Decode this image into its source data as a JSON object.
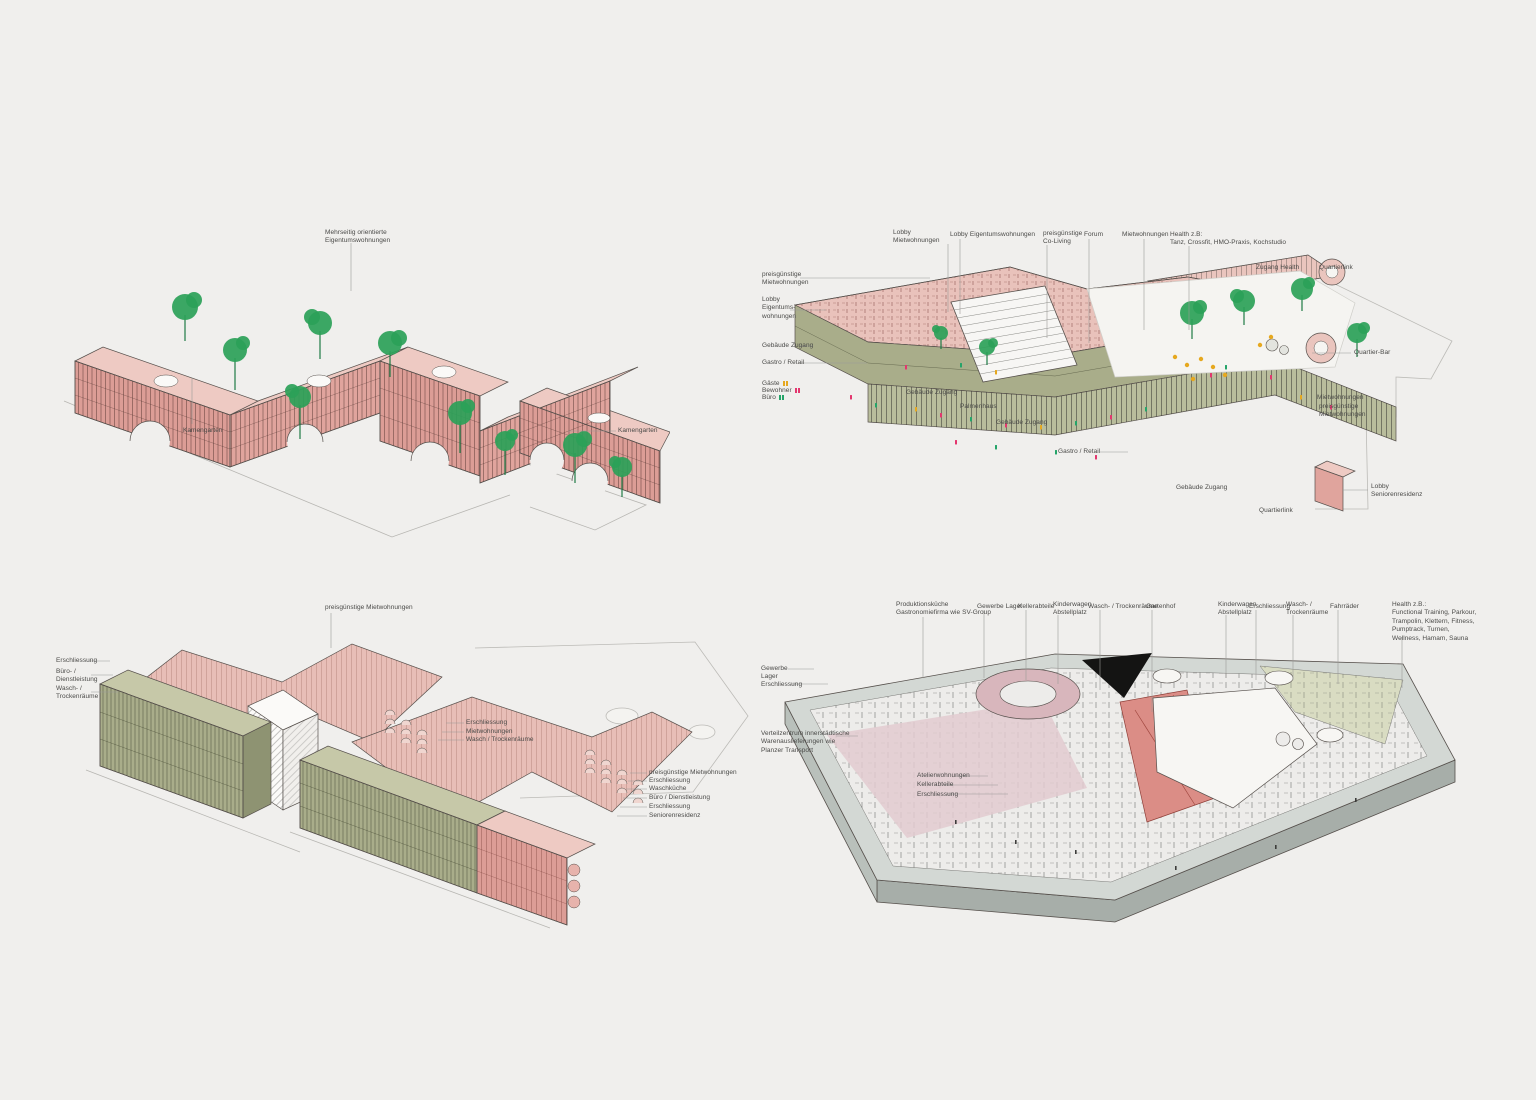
{
  "page": {
    "background": "#f0efed",
    "ink": "#56504c",
    "label_color": "#4a4a48"
  },
  "figure": {
    "type": "architectural-axonometric-set",
    "panel_count": 4
  },
  "palette": {
    "pink_wall": "#dc9d96",
    "pink_roof": "#eecac3",
    "olive": "#a9ad8a",
    "tree_green": "#2ba158",
    "grey_plate": "#d3d8d4",
    "people_guest": "#e6a81f",
    "people_resident": "#e3366e",
    "people_office": "#25a469"
  },
  "panels": [
    {
      "id": "upper-floors",
      "name": "axon-upper-floors",
      "annotations": [
        {
          "t": [
            "Mehrseitig orientierte",
            "Eigentumswohnungen"
          ],
          "x": 325,
          "y": 229,
          "l": [
            351,
            243,
            351,
            291
          ]
        },
        {
          "t": [
            "Kamengarten"
          ],
          "x": 183,
          "y": 427,
          "l": [
            192,
            424,
            192,
            378
          ]
        },
        {
          "t": [
            "Kamengarten"
          ],
          "x": 618,
          "y": 427,
          "l": [
            616,
            431,
            568,
            431
          ]
        }
      ]
    },
    {
      "id": "ground-floor",
      "name": "axon-ground-floor",
      "annotations": [
        {
          "t": [
            "Lobby",
            "Mietwohnungen"
          ],
          "x": 893,
          "y": 229,
          "l": [
            948,
            244,
            948,
            312
          ]
        },
        {
          "t": [
            "Lobby Eigentumswohnungen"
          ],
          "x": 950,
          "y": 231,
          "l": [
            960,
            239,
            960,
            314
          ]
        },
        {
          "t": [
            "preisgünstige",
            "Co-Living"
          ],
          "x": 1043,
          "y": 230,
          "l": [
            1047,
            245,
            1047,
            338
          ]
        },
        {
          "t": [
            "Forum"
          ],
          "x": 1084,
          "y": 231,
          "l": [
            1089,
            239,
            1089,
            343
          ]
        },
        {
          "t": [
            "Mietwohnungen"
          ],
          "x": 1122,
          "y": 231,
          "l": [
            1144,
            239,
            1144,
            330
          ]
        },
        {
          "t": [
            "Health z.B:",
            "Tanz, Crossfit, HMO-Praxis, Kochstudio"
          ],
          "x": 1170,
          "y": 231,
          "l": [
            1189,
            246,
            1189,
            330
          ]
        },
        {
          "t": [
            "Zugang Health"
          ],
          "x": 1256,
          "y": 264
        },
        {
          "t": [
            "Quartierlink"
          ],
          "x": 1319,
          "y": 264
        },
        {
          "t": [
            "Quartier-Bar"
          ],
          "x": 1354,
          "y": 349,
          "l": [
            1351,
            353,
            1312,
            353
          ]
        },
        {
          "t": [
            "preisgünstige",
            "Mietwohnungen"
          ],
          "x": 762,
          "y": 271,
          "l": [
            800,
            278,
            930,
            278
          ]
        },
        {
          "t": [
            "Lobby",
            "Eigentums-",
            "wohnungen"
          ],
          "x": 762,
          "y": 296,
          "l": [
            790,
            310,
            826,
            310
          ]
        },
        {
          "t": [
            "Gebäude Zugang"
          ],
          "x": 762,
          "y": 342,
          "l": [
            800,
            346,
            813,
            346
          ]
        },
        {
          "t": [
            "Gastro / Retail"
          ],
          "x": 762,
          "y": 359,
          "l": [
            801,
            363,
            867,
            363
          ]
        },
        {
          "t": [
            "Gäste"
          ],
          "x": 762,
          "y": 380,
          "m": "#e6a81f"
        },
        {
          "t": [
            "Bewohner"
          ],
          "x": 762,
          "y": 387,
          "m": "#e3366e"
        },
        {
          "t": [
            "Büro"
          ],
          "x": 762,
          "y": 394,
          "m": "#25a469"
        },
        {
          "t": [
            "Gebäude Zugang"
          ],
          "x": 906,
          "y": 389
        },
        {
          "t": [
            "Palmenhaus"
          ],
          "x": 960,
          "y": 403
        },
        {
          "t": [
            "Gebäude Zugang"
          ],
          "x": 996,
          "y": 419
        },
        {
          "t": [
            "Gastro / Retail"
          ],
          "x": 1058,
          "y": 448,
          "l": [
            1100,
            452,
            1128,
            452
          ]
        },
        {
          "t": [
            "Gebäude Zugang"
          ],
          "x": 1176,
          "y": 484
        },
        {
          "t": [
            "Quartierlink"
          ],
          "x": 1259,
          "y": 507
        },
        {
          "t": [
            "Lobby",
            "Seniorenresidenz"
          ],
          "x": 1371,
          "y": 483,
          "l": [
            1368,
            490,
            1342,
            490
          ]
        },
        {
          "t": [
            "Mietwohnungen"
          ],
          "x": 1317,
          "y": 394
        },
        {
          "t": [
            "preisgünstige",
            "Mietwohnungen"
          ],
          "x": 1319,
          "y": 403
        }
      ]
    },
    {
      "id": "standard-floors",
      "name": "axon-standard-floors",
      "annotations": [
        {
          "t": [
            "preisgünstige Mietwohnungen"
          ],
          "x": 325,
          "y": 604,
          "l": [
            331,
            613,
            331,
            648
          ]
        },
        {
          "t": [
            "Erschliessung"
          ],
          "x": 56,
          "y": 657,
          "l": [
            89,
            661,
            110,
            661
          ]
        },
        {
          "t": [
            "Büro- /",
            "Dienstleistung"
          ],
          "x": 56,
          "y": 668,
          "l": [
            91,
            675,
            113,
            675
          ]
        },
        {
          "t": [
            "Wasch- /",
            "Trockenräume"
          ],
          "x": 56,
          "y": 685,
          "l": [
            91,
            692,
            118,
            692
          ]
        },
        {
          "t": [
            "Erschliessung"
          ],
          "x": 466,
          "y": 719,
          "l": [
            464,
            723,
            446,
            723
          ]
        },
        {
          "t": [
            "Mietwohnungen"
          ],
          "x": 466,
          "y": 728,
          "l": [
            464,
            732,
            442,
            732
          ]
        },
        {
          "t": [
            "Wasch / Trockenräume"
          ],
          "x": 466,
          "y": 736,
          "l": [
            464,
            740,
            438,
            740
          ]
        },
        {
          "t": [
            "preisgünstige Mietwohnungen"
          ],
          "x": 649,
          "y": 769,
          "l": [
            647,
            773,
            630,
            773
          ]
        },
        {
          "t": [
            "Erschliessung"
          ],
          "x": 649,
          "y": 777,
          "l": [
            647,
            781,
            628,
            781
          ]
        },
        {
          "t": [
            "Waschküche"
          ],
          "x": 649,
          "y": 785,
          "l": [
            647,
            789,
            626,
            789
          ]
        },
        {
          "t": [
            "Büro / Dienstleistung"
          ],
          "x": 649,
          "y": 794,
          "l": [
            647,
            798,
            623,
            798
          ]
        },
        {
          "t": [
            "Erschliessung"
          ],
          "x": 649,
          "y": 803,
          "l": [
            647,
            807,
            620,
            807
          ]
        },
        {
          "t": [
            "Seniorenresidenz"
          ],
          "x": 649,
          "y": 812,
          "l": [
            647,
            816,
            617,
            816
          ]
        }
      ]
    },
    {
      "id": "basement",
      "name": "axon-basement",
      "annotations": [
        {
          "t": [
            "Produktionsküche",
            "Gastronomiefirma wie SV-Group"
          ],
          "x": 896,
          "y": 601,
          "l": [
            923,
            617,
            923,
            678
          ]
        },
        {
          "t": [
            "Gewerbe Lager"
          ],
          "x": 977,
          "y": 603,
          "l": [
            984,
            610,
            984,
            678
          ]
        },
        {
          "t": [
            "Kellerabteile"
          ],
          "x": 1018,
          "y": 603,
          "l": [
            1026,
            610,
            1026,
            680
          ]
        },
        {
          "t": [
            "Kinderwagen",
            "Abstellplatz"
          ],
          "x": 1053,
          "y": 601,
          "l": [
            1058,
            615,
            1058,
            684
          ]
        },
        {
          "t": [
            "Wasch- / Trockenräume"
          ],
          "x": 1088,
          "y": 603,
          "l": [
            1100,
            610,
            1100,
            690
          ]
        },
        {
          "t": [
            "Gartenhof"
          ],
          "x": 1146,
          "y": 603,
          "l": [
            1152,
            610,
            1152,
            712
          ]
        },
        {
          "t": [
            "Kinderwagen",
            "Abstellplatz"
          ],
          "x": 1218,
          "y": 601,
          "l": [
            1226,
            615,
            1226,
            678
          ]
        },
        {
          "t": [
            "Erschliessung"
          ],
          "x": 1249,
          "y": 603,
          "l": [
            1256,
            610,
            1256,
            680
          ]
        },
        {
          "t": [
            "Wasch- /",
            "Trockenräume"
          ],
          "x": 1286,
          "y": 601,
          "l": [
            1293,
            615,
            1293,
            680
          ]
        },
        {
          "t": [
            "Fahrräder"
          ],
          "x": 1330,
          "y": 603,
          "l": [
            1338,
            610,
            1338,
            684
          ]
        },
        {
          "t": [
            "Health z.B.:",
            "Functional Training, Parkour,",
            "Trampolin, Klettern, Fitness,",
            "Pumptrack, Turnen,",
            "Wellness, Hamam, Sauna"
          ],
          "x": 1392,
          "y": 601,
          "l": [
            1402,
            637,
            1402,
            688
          ]
        },
        {
          "t": [
            "Gewerbe",
            "Lager"
          ],
          "x": 761,
          "y": 665,
          "l": [
            788,
            669,
            814,
            669
          ]
        },
        {
          "t": [
            "Erschliessung"
          ],
          "x": 761,
          "y": 681,
          "l": [
            792,
            684,
            828,
            684
          ]
        },
        {
          "t": [
            "Verteilzentrum innerstädtische",
            "Warenauslieferungen wie",
            "Planzer Transport"
          ],
          "x": 761,
          "y": 730,
          "l": [
            836,
            736,
            858,
            736
          ]
        },
        {
          "t": [
            "Atelierwohnungen"
          ],
          "x": 917,
          "y": 772,
          "l": [
            956,
            776,
            988,
            776
          ]
        },
        {
          "t": [
            "Kellerabteile"
          ],
          "x": 917,
          "y": 781,
          "l": [
            945,
            785,
            998,
            785
          ]
        },
        {
          "t": [
            "Erschliessung"
          ],
          "x": 917,
          "y": 791,
          "l": [
            947,
            794,
            1008,
            794
          ]
        }
      ]
    }
  ]
}
